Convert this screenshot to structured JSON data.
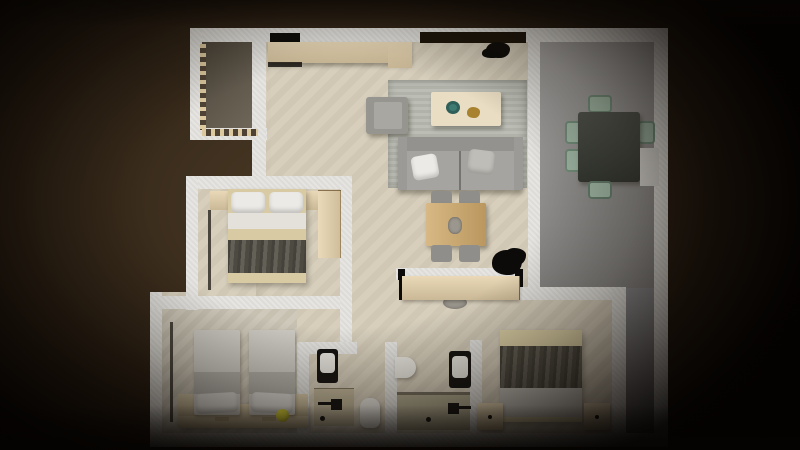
{
  "scene": {
    "title": "Top-down 3D rendered floor plan of a three-bedroom apartment",
    "background": "#2e2216"
  },
  "palette": {
    "wall": "#e5e4e0",
    "floor_main": "#d6cdba",
    "floor_bedroom_twin": "#cdc7b8",
    "floor_terrace": "#675e4f",
    "floor_dining": "#9e9d9b",
    "floor_balcony_strip": "#838286",
    "shower_tray": "#c3b89c",
    "shower_green": "#b0a98f",
    "wood_light": "#e6d2ab",
    "wood_mid": "#cfa869",
    "wood_platform": "#d7c6a0",
    "sofa_gray": "#a5a4a0",
    "armchair_gray": "#96958f",
    "rug_gray": "#b8bab1",
    "chair_gray": "#8f8e8a",
    "chair_sage": "#9fb7a5",
    "dining_table_dark": "#40453d",
    "blanket_dark": "#57544a",
    "bed_twin_light": "#cecbc5",
    "bed_twin_band": "#b3b0aa",
    "pillow_white": "#eceae6",
    "sheet_white": "#e4e1da",
    "mattress_beige": "#d8cba4",
    "fixture_black": "#141311",
    "fixture_white": "#e8e6e0",
    "radiator_dark": "#4a453d",
    "ball_yellow": "#ddd434",
    "bowl_teal": "#3c7a72",
    "decor_gold": "#a8822f",
    "ac_white": "#d9d8d4",
    "stool_gray": "#9b978e",
    "tv_black": "#0d0c0a",
    "plant_black": "#0c0b09"
  },
  "rooms": [
    {
      "id": "living-room",
      "label": "living room",
      "furniture": [
        "tv-console",
        "tv",
        "kitchen-counter",
        "kitchen-cabinet",
        "plant",
        "rug",
        "armchair",
        "sofa",
        "sofa-pillows",
        "coffee-table",
        "teal-bowl",
        "gold-decor",
        "work-table",
        "chairs-4",
        "plant",
        "stool"
      ]
    },
    {
      "id": "dining-balcony",
      "label": "dining / balcony (gray floor, L-shaped)",
      "furniture": [
        "dining-table",
        "sage-chairs-6",
        "ac-unit"
      ]
    },
    {
      "id": "terrace",
      "label": "terrace with dashed tile border",
      "furniture": []
    },
    {
      "id": "bedroom-1",
      "label": "bedroom middle-left",
      "furniture": [
        "double-bed",
        "pillows-2",
        "nightstands-2",
        "wardrobe",
        "radiator"
      ]
    },
    {
      "id": "bedroom-2",
      "label": "bedroom bottom-left (twin)",
      "furniture": [
        "twin-bed",
        "twin-bed",
        "wood-platform",
        "corner-tables-2",
        "yellow-ball",
        "radiator"
      ]
    },
    {
      "id": "bathroom-1",
      "label": "bathroom left",
      "furniture": [
        "toilet",
        "shower-tray",
        "shower-fixture",
        "pedestal-sink"
      ]
    },
    {
      "id": "bathroom-2",
      "label": "bathroom right (ensuite)",
      "furniture": [
        "wall-sink",
        "toilet",
        "shower-floor",
        "shower-fixture"
      ]
    },
    {
      "id": "bedroom-3",
      "label": "bedroom bottom-right",
      "furniture": [
        "double-bed",
        "nightstands-2",
        "closet",
        "entry-stool"
      ]
    },
    {
      "id": "hallway",
      "label": "hallway",
      "furniture": []
    }
  ]
}
